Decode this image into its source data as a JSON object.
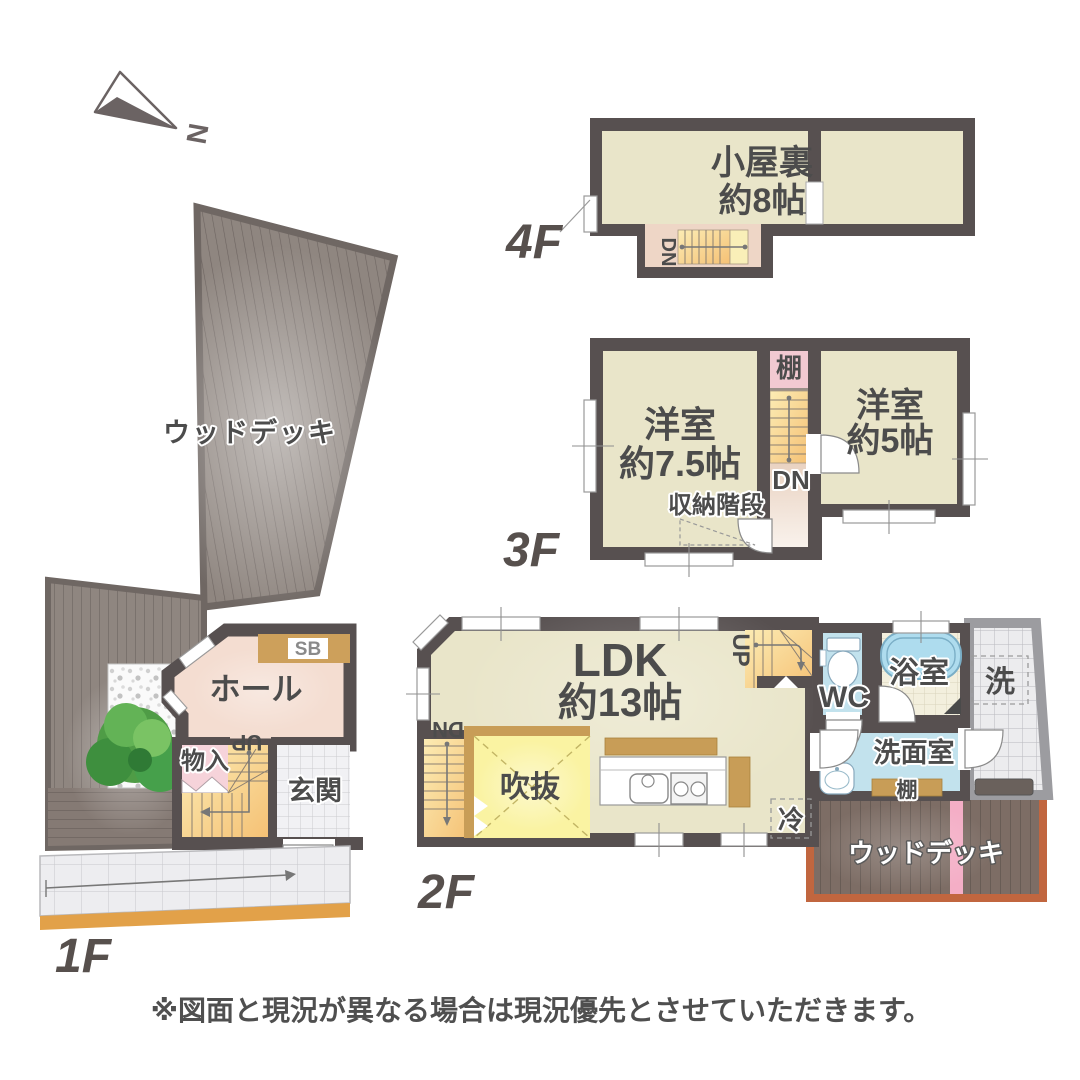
{
  "north": {
    "letter": "N"
  },
  "floors": {
    "f4": {
      "label": "4F",
      "attic": "小屋裏",
      "attic_size": "約8帖",
      "dn": "DN"
    },
    "f3": {
      "label": "3F",
      "west_name": "洋室",
      "west_size": "約7.5帖",
      "east_name": "洋室",
      "east_size": "約5帖",
      "shelf": "棚",
      "dn": "DN",
      "storage_stairs": "収納階段"
    },
    "f2": {
      "label": "2F",
      "ldk": "LDK",
      "ldk_size": "約13帖",
      "void": "吹抜",
      "dn": "DN",
      "up": "UP",
      "wc": "WC",
      "bath": "浴室",
      "laundry": "洗",
      "washroom": "洗面室",
      "shelf": "棚",
      "fridge": "冷",
      "deck": "ウッドデッキ"
    },
    "f1": {
      "label": "1F",
      "deck": "ウッドデッキ",
      "hall": "ホール",
      "sb": "SB",
      "storage": "物入",
      "up": "UP",
      "entrance": "玄関"
    }
  },
  "disclaimer": "※図面と現況が異なる場合は現況優先とさせていただきます。",
  "palette": {
    "wall": "#575050",
    "wallLight": "#9c9ca0",
    "roomBeige": "#e9e5c9",
    "hallPink": "#f4ddd1",
    "storagePink": "#f6d3da",
    "shelfPink": "#f2c9d1",
    "corridorPink": "#e9d2c1",
    "stairOrangeA": "#f7cc86",
    "stairOrangeB": "#fcecb4",
    "waterBlue": "#c2e2ed",
    "tubBlue": "#aedcee",
    "bathFloor": "#f3efdd",
    "voidYellow": "#faf3a2",
    "counterBrown": "#c89d57",
    "sbBrown": "#cda05b",
    "deckGray": "#8f8680",
    "deckGrayLine": "#6d6460",
    "deckBrown": "#7d6d65",
    "deckBrownLine": "#5c524c",
    "deckBorder": "#c1663f",
    "pinkStripe": "#f4aec6",
    "approachOrange": "#e2a149",
    "labelGray": "#57504d",
    "textGray": "#4c4c4c"
  }
}
